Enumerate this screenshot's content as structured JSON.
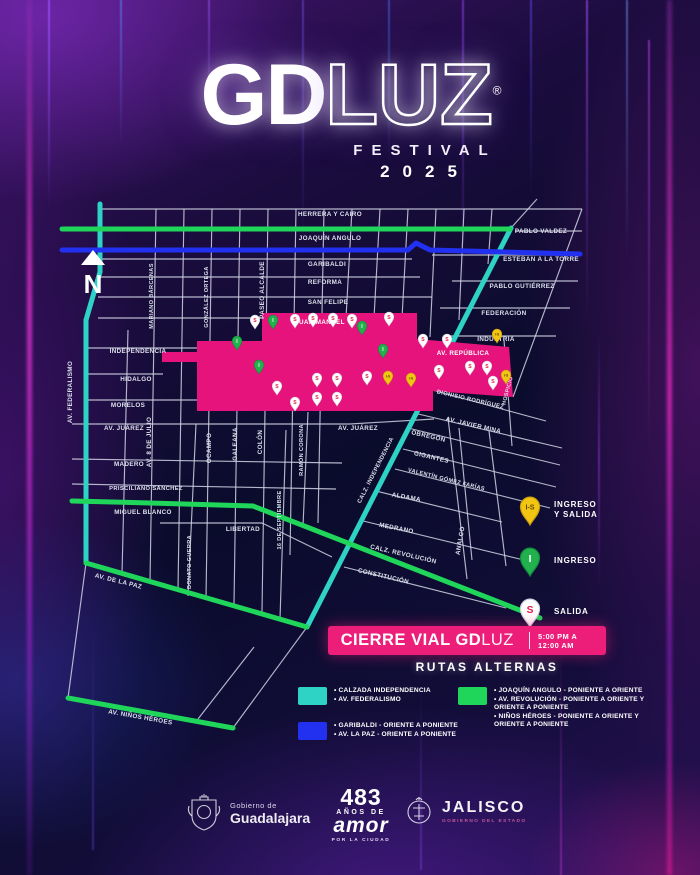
{
  "header": {
    "logo_bold": "GD",
    "logo_light": "LUZ",
    "reg": "®",
    "festival": "FESTIVAL",
    "year": "2025"
  },
  "north": "N",
  "colors": {
    "pink": "#e6137c",
    "banner_pink": "#ec1e79",
    "cyan": "#2ed3c5",
    "green": "#1fd65a",
    "blue": "#2231f0",
    "street": "#d2d5e6",
    "salida_red": "#e8174b",
    "ingreso_green": "#22b14c",
    "is_yellow": "#f3c513"
  },
  "map": {
    "labels": [
      {
        "t": "HERRERA Y CAIRO",
        "x": 330,
        "y": 216
      },
      {
        "t": "JOAQUÍN ANGULO",
        "x": 330,
        "y": 240
      },
      {
        "t": "PABLO VALDEZ",
        "x": 541,
        "y": 233
      },
      {
        "t": "GARIBALDI",
        "x": 327,
        "y": 266
      },
      {
        "t": "ESTEBAN A LA TORRE",
        "x": 541,
        "y": 261
      },
      {
        "t": "REFORMA",
        "x": 325,
        "y": 284
      },
      {
        "t": "PABLO GUTIÉRREZ",
        "x": 522,
        "y": 288
      },
      {
        "t": "SAN FELIPE",
        "x": 328,
        "y": 304
      },
      {
        "t": "FEDERACIÓN",
        "x": 504,
        "y": 315
      },
      {
        "t": "JUAN MANUEL",
        "x": 320,
        "y": 324,
        "c": "#ffffff"
      },
      {
        "t": "INDUSTRIA",
        "x": 496,
        "y": 341
      },
      {
        "t": "INDEPENDENCIA",
        "x": 138,
        "y": 353
      },
      {
        "t": "AV. REPÚBLICA",
        "x": 463,
        "y": 355,
        "c": "#ffffff"
      },
      {
        "t": "HIDALGO",
        "x": 136,
        "y": 381
      },
      {
        "t": "MORELOS",
        "x": 128,
        "y": 407
      },
      {
        "t": "AV. JUÁREZ",
        "x": 124,
        "y": 430
      },
      {
        "t": "AV. JUÁREZ",
        "x": 358,
        "y": 430
      },
      {
        "t": "MADERO",
        "x": 129,
        "y": 466
      },
      {
        "t": "PRISCILIANO SÁNCHEZ",
        "x": 146,
        "y": 490,
        "s": 5.8
      },
      {
        "t": "MIGUEL BLANCO",
        "x": 143,
        "y": 514
      },
      {
        "t": "LIBERTAD",
        "x": 243,
        "y": 531
      },
      {
        "t": "DIONISIO RODRÍGUEZ",
        "x": 470,
        "y": 401,
        "r": 13,
        "s": 5.8
      },
      {
        "t": "AV. JAVIER MINA",
        "x": 473,
        "y": 427,
        "r": 13
      },
      {
        "t": "OBREGÓN",
        "x": 428,
        "y": 438,
        "r": 13
      },
      {
        "t": "GIGANTES",
        "x": 431,
        "y": 459,
        "r": 13
      },
      {
        "t": "VALENTÍN GÓMEZ FARÍAS",
        "x": 446,
        "y": 481,
        "r": 14,
        "s": 5.6
      },
      {
        "t": "ALDAMA",
        "x": 406,
        "y": 499,
        "r": 10
      },
      {
        "t": "MEDRANO",
        "x": 396,
        "y": 530,
        "r": 11
      },
      {
        "t": "CALZ. REVOLUCIÓN",
        "x": 403,
        "y": 556,
        "r": 13
      },
      {
        "t": "CONSTITUCIÓN",
        "x": 383,
        "y": 578,
        "r": 13
      },
      {
        "t": "AV. DE LA PAZ",
        "x": 118,
        "y": 583,
        "r": 14
      },
      {
        "t": "AV. NIÑOS HÉROES",
        "x": 140,
        "y": 719,
        "r": 10
      },
      {
        "t": "AV. FEDERALISMO",
        "x": 72,
        "y": 392,
        "r": -90
      },
      {
        "t": "MARIANO BÁRCENAS",
        "x": 153,
        "y": 296,
        "r": -90,
        "s": 5.6
      },
      {
        "t": "GONZÁLEZ ORTEGA",
        "x": 208,
        "y": 297,
        "r": -90,
        "s": 5.6
      },
      {
        "t": "PASEO ALCALDE",
        "x": 264,
        "y": 290,
        "r": -90
      },
      {
        "t": "AV. 8 DE JULIO",
        "x": 151,
        "y": 442,
        "r": -90
      },
      {
        "t": "OCAMPO",
        "x": 211,
        "y": 448,
        "r": -90
      },
      {
        "t": "GALEANA",
        "x": 237,
        "y": 444,
        "r": -90
      },
      {
        "t": "COLÓN",
        "x": 262,
        "y": 442,
        "r": -90
      },
      {
        "t": "RAMÓN CORONA",
        "x": 303,
        "y": 450,
        "r": -90,
        "s": 5.6
      },
      {
        "t": "16 DE SEPTIEMBRE",
        "x": 281,
        "y": 520,
        "r": -90,
        "s": 5.6
      },
      {
        "t": "DONATO GUERRA",
        "x": 191,
        "y": 562,
        "r": -90,
        "s": 5.6
      },
      {
        "t": "ANALCO",
        "x": 462,
        "y": 541,
        "r": -80
      },
      {
        "t": "HOSPICIO",
        "x": 509,
        "y": 391,
        "r": -75,
        "s": 5.4
      },
      {
        "t": "CALZ. INDEPENDENCIA",
        "x": 377,
        "y": 471,
        "r": -63,
        "s": 5.8
      }
    ],
    "routes": [
      {
        "name": "av-federalismo",
        "color": "cyan",
        "points": [
          [
            100,
            204
          ],
          [
            100,
            272
          ],
          [
            86,
            320
          ],
          [
            86,
            563
          ]
        ]
      },
      {
        "name": "calz-independencia",
        "color": "cyan",
        "points": [
          [
            511,
            228
          ],
          [
            307,
            627
          ]
        ]
      },
      {
        "name": "joaquin-angulo",
        "color": "green",
        "points": [
          [
            62,
            229
          ],
          [
            510,
            229
          ]
        ]
      },
      {
        "name": "garibaldi-esteban-a-la-torre",
        "color": "blue",
        "points": [
          [
            62,
            250
          ],
          [
            408,
            250
          ],
          [
            416,
            243
          ],
          [
            430,
            250
          ],
          [
            580,
            254
          ]
        ]
      },
      {
        "name": "av-revolucion",
        "color": "green",
        "points": [
          [
            72,
            501
          ],
          [
            150,
            503
          ],
          [
            253,
            506
          ],
          [
            540,
            618
          ]
        ]
      },
      {
        "name": "av-la-paz",
        "color": "green",
        "points": [
          [
            86,
            563
          ],
          [
            307,
            627
          ]
        ]
      },
      {
        "name": "ninos-heroes",
        "color": "green",
        "points": [
          [
            68,
            698
          ],
          [
            233,
            728
          ]
        ]
      }
    ],
    "pins": {
      "salida": [
        [
          255,
          329
        ],
        [
          295,
          328
        ],
        [
          313,
          327
        ],
        [
          333,
          327
        ],
        [
          352,
          328
        ],
        [
          389,
          326
        ],
        [
          423,
          348
        ],
        [
          447,
          348
        ],
        [
          277,
          395
        ],
        [
          295,
          411
        ],
        [
          317,
          387
        ],
        [
          317,
          406
        ],
        [
          337,
          387
        ],
        [
          337,
          406
        ],
        [
          367,
          385
        ],
        [
          439,
          379
        ],
        [
          470,
          375
        ],
        [
          487,
          375
        ],
        [
          493,
          390
        ]
      ],
      "ingreso": [
        [
          273,
          329
        ],
        [
          237,
          350
        ],
        [
          362,
          335
        ],
        [
          383,
          358
        ],
        [
          259,
          374
        ]
      ],
      "ingreso_salida": [
        [
          497,
          343
        ],
        [
          388,
          385
        ],
        [
          411,
          387
        ],
        [
          506,
          384
        ]
      ]
    },
    "pin_letters": {
      "salida": "S",
      "ingreso": "I",
      "ingreso_salida": "I-S"
    }
  },
  "legend": {
    "items": [
      {
        "kind": "ingreso_salida",
        "label_lines": [
          "INGRESO",
          "Y SALIDA"
        ]
      },
      {
        "kind": "ingreso",
        "label_lines": [
          "INGRESO"
        ]
      },
      {
        "kind": "salida",
        "label_lines": [
          "SALIDA"
        ]
      }
    ]
  },
  "banner": {
    "bold": "CIERRE VIAL GD",
    "light": "LUZ",
    "time1": "5:00 PM A",
    "time2": "12:00 AM"
  },
  "rutas": {
    "title": "RUTAS ALTERNAS",
    "groups": [
      {
        "color_key": "cyan",
        "lines": [
          "• CALZADA INDEPENDENCIA",
          "• AV. FEDERALISMO"
        ]
      },
      {
        "color_key": "blue",
        "lines": [
          "• GARIBALDI - ORIENTE A PONIENTE",
          "• AV. LA PAZ - ORIENTE A PONIENTE"
        ]
      },
      {
        "color_key": "green",
        "lines": [
          "• JOAQUÍN ANGULO - PONIENTE A ORIENTE",
          "• AV. REVOLUCIÓN - PONIENTE A ORIENTE Y ORIENTE A PONIENTE",
          "• NIÑOS HÉROES - PONIENTE A ORIENTE Y ORIENTE A PONIENTE"
        ]
      }
    ]
  },
  "footer": {
    "gob_small": "Gobierno de",
    "gob_big": "Guadalajara",
    "num": "483",
    "anos": "AÑOS DE",
    "amor": "amor",
    "ciudad": "POR LA CIUDAD",
    "jal": "JALISCO",
    "jal_sub": "GOBIERNO DEL ESTADO"
  }
}
